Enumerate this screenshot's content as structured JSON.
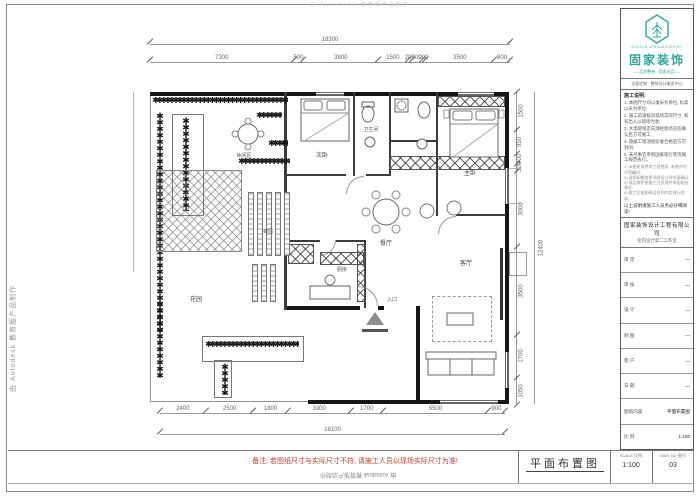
{
  "watermarks": {
    "left": "由 Autodesk 教育版产品制作",
    "top": "由 Autodesk 教育版产品制作",
    "bottom": "由 Autodesk 教育版产品制作"
  },
  "frame": {
    "red_note": "备注: 若图纸尺寸与实际尺寸不符, 请施工人员以现场实际尺寸为准!"
  },
  "brand": {
    "name": "固家装饰",
    "sub": "GUJIA ZHUANGSHI",
    "tagline": "— 品质整装 · 固家出品 —",
    "accent": "#33a69f"
  },
  "title_block": {
    "contact": "全屋定制 · 整装设计服务中心",
    "notes_title": "施工说明:",
    "notes": [
      "1. 本图尺寸均以毫米为单位, 标高以米为单位;",
      "2. 施工前请核对现场实际尺寸, 如有出入以现场为准;",
      "3. 水电管线走向须经现场交底确认后方可施工;",
      "4. 隐蔽工程须经验收合格后方可封闭;",
      "5. 未尽事宜参照国家现行装饰施工规范执行。"
    ],
    "fine_print": [
      "1) 本图纸仅供本工程使用, 未经许可不得翻印;",
      "2) 现场如需变更须经设计师书面确认;",
      "3) 成品保护由施工方负责并承担相应责任;",
      "4) 竣工后按图纸及合同约定进行验收。"
    ],
    "notice": "以上说明请施工人员务必仔细阅读!",
    "company": "固家装饰设计工程有限公司",
    "dept": "室内设计第二工作室",
    "fields": [
      {
        "label": "审 定",
        "value": "—"
      },
      {
        "label": "审 核",
        "value": "—"
      },
      {
        "label": "设 计",
        "value": "—"
      },
      {
        "label": "制 图",
        "value": "—"
      },
      {
        "label": "客 户",
        "value": "—"
      },
      {
        "label": "日 期",
        "value": "—"
      },
      {
        "label": "图纸内容",
        "value": "平面布置图"
      },
      {
        "label": "比 例",
        "value": "1:100"
      }
    ]
  },
  "sheet": {
    "drawing_title": "平面布置图",
    "scale_label": "SCALE 比例",
    "scale_value": "1:100",
    "no_label": "DWG NO 图号",
    "no_value": "03"
  },
  "dimensions": {
    "top": {
      "total": "18300",
      "segments": [
        "7300",
        "500",
        "3800",
        "1500",
        "200",
        "500",
        "200",
        "3500",
        "800"
      ]
    },
    "bottom": {
      "total": "18100",
      "segments": [
        "2400",
        "2500",
        "1800",
        "3300",
        "1700",
        "5500",
        "900"
      ]
    },
    "right": {
      "total": "12400",
      "segments": [
        "1500",
        "950",
        "400",
        "300",
        "3000",
        "3500",
        "1700",
        "1050"
      ]
    }
  },
  "rooms": {
    "bed2": "次卧",
    "bath": "卫生间",
    "master": "主卧",
    "cloak": "衣帽间",
    "dining": "餐厅",
    "living": "客厅",
    "kitchen": "厨房",
    "study": "书房",
    "leisure": "休闲区",
    "veg": "菜园",
    "garden": "花园",
    "entry": "入口"
  },
  "plants": {
    "row": "✱✱✱✱✱✱✱✱✱✱✱✱✱✱✱✱✱✱✱✱✱✱✱✱✱✱✱✱✱✱✱✱✱✱✱✱"
  }
}
